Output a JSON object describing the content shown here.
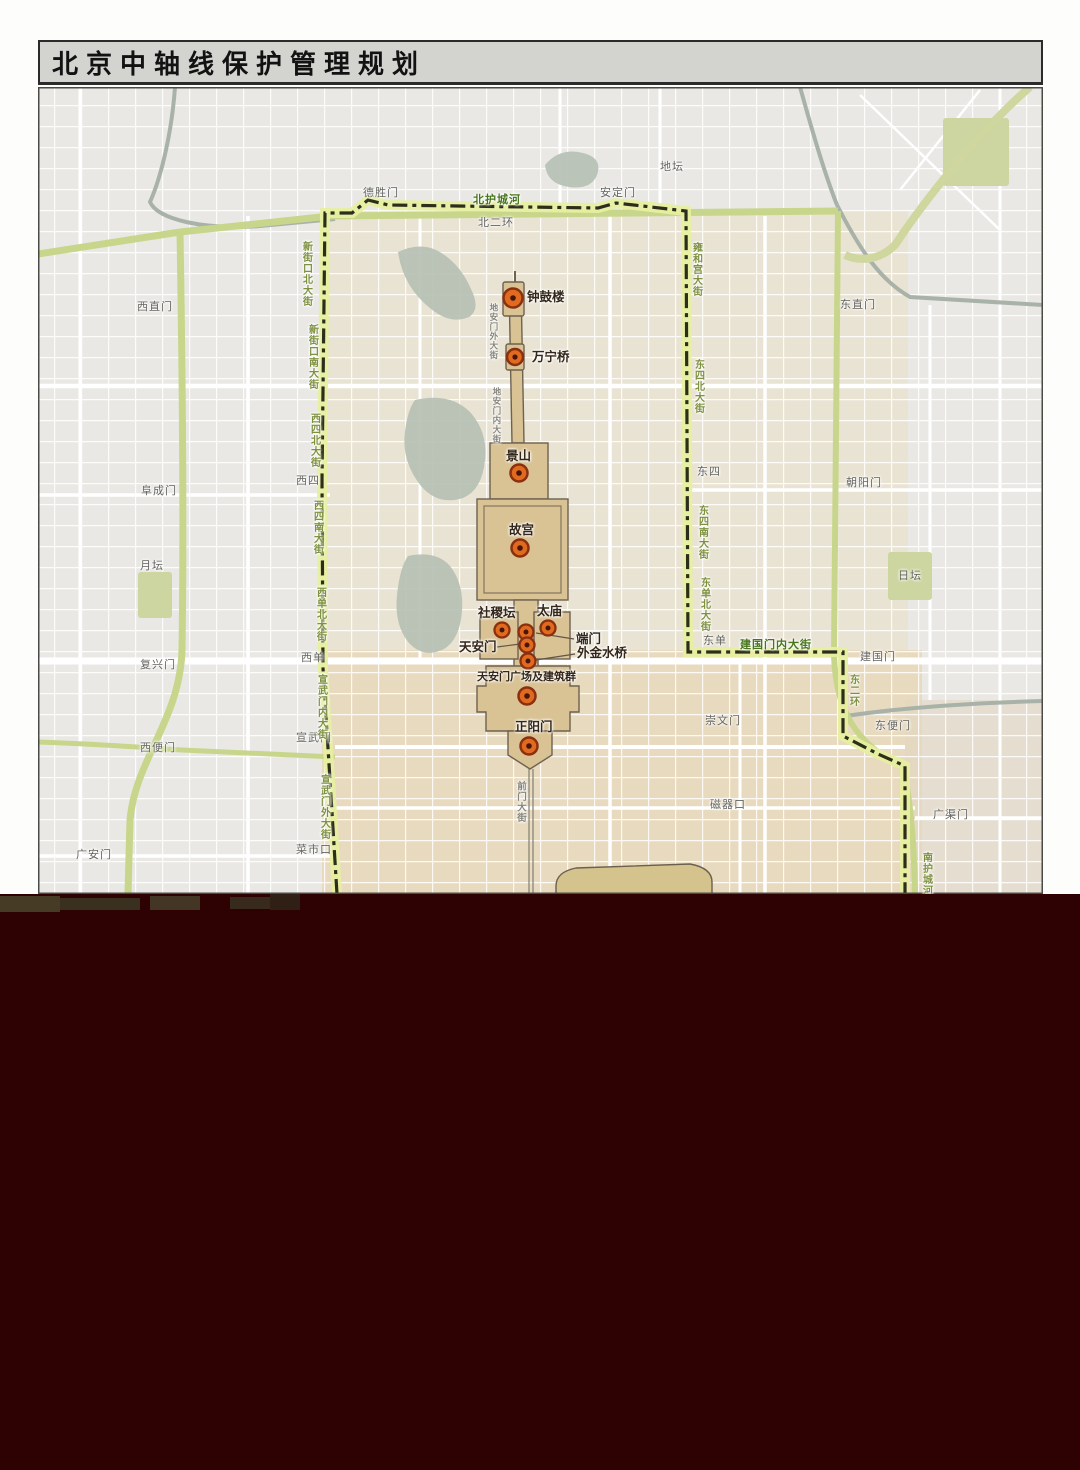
{
  "title": "北京中轴线保护管理规划",
  "map": {
    "sites": [
      "钟鼓楼",
      "万宁桥",
      "景山",
      "故宫",
      "社稷坛",
      "太庙",
      "端门",
      "天安门",
      "外金水桥",
      "天安门广场及建筑群",
      "正阳门"
    ],
    "gates": [
      "德胜门",
      "安定门",
      "地坛",
      "西直门",
      "东直门",
      "阜成门",
      "朝阳门",
      "西四",
      "东四",
      "月坛",
      "日坛",
      "复兴门",
      "西单",
      "东单",
      "建国门",
      "西便门",
      "宣武门",
      "崇文门",
      "东便门",
      "广安门",
      "菜市口",
      "磁器口",
      "广渠门",
      "北二环"
    ],
    "streets": [
      "新街口北大街",
      "新街口南大街",
      "西四北大街",
      "西四南大街",
      "西单北大街",
      "宣武门内大街",
      "宣武门外大街",
      "雍和宫大街",
      "东四北大街",
      "东四南大街",
      "东单北大街",
      "东二环",
      "南护城河"
    ],
    "axis_streets": [
      "地安门外大街",
      "地安门内大街",
      "前门大街"
    ],
    "bold_roads": [
      "北护城河",
      "建国门内大街"
    ],
    "colors": {
      "boundary_dash": "#2d2d1c",
      "boundary_glow": "#e7efa0",
      "heritage_fill": "#d9c294",
      "marker_orange": "#e06a1e",
      "green_road": "#c8d68c",
      "water": "#b6c0b4",
      "park": "#cdd5a0",
      "dark_band": "#2e0202",
      "title_band": "#d3d3d0"
    }
  }
}
